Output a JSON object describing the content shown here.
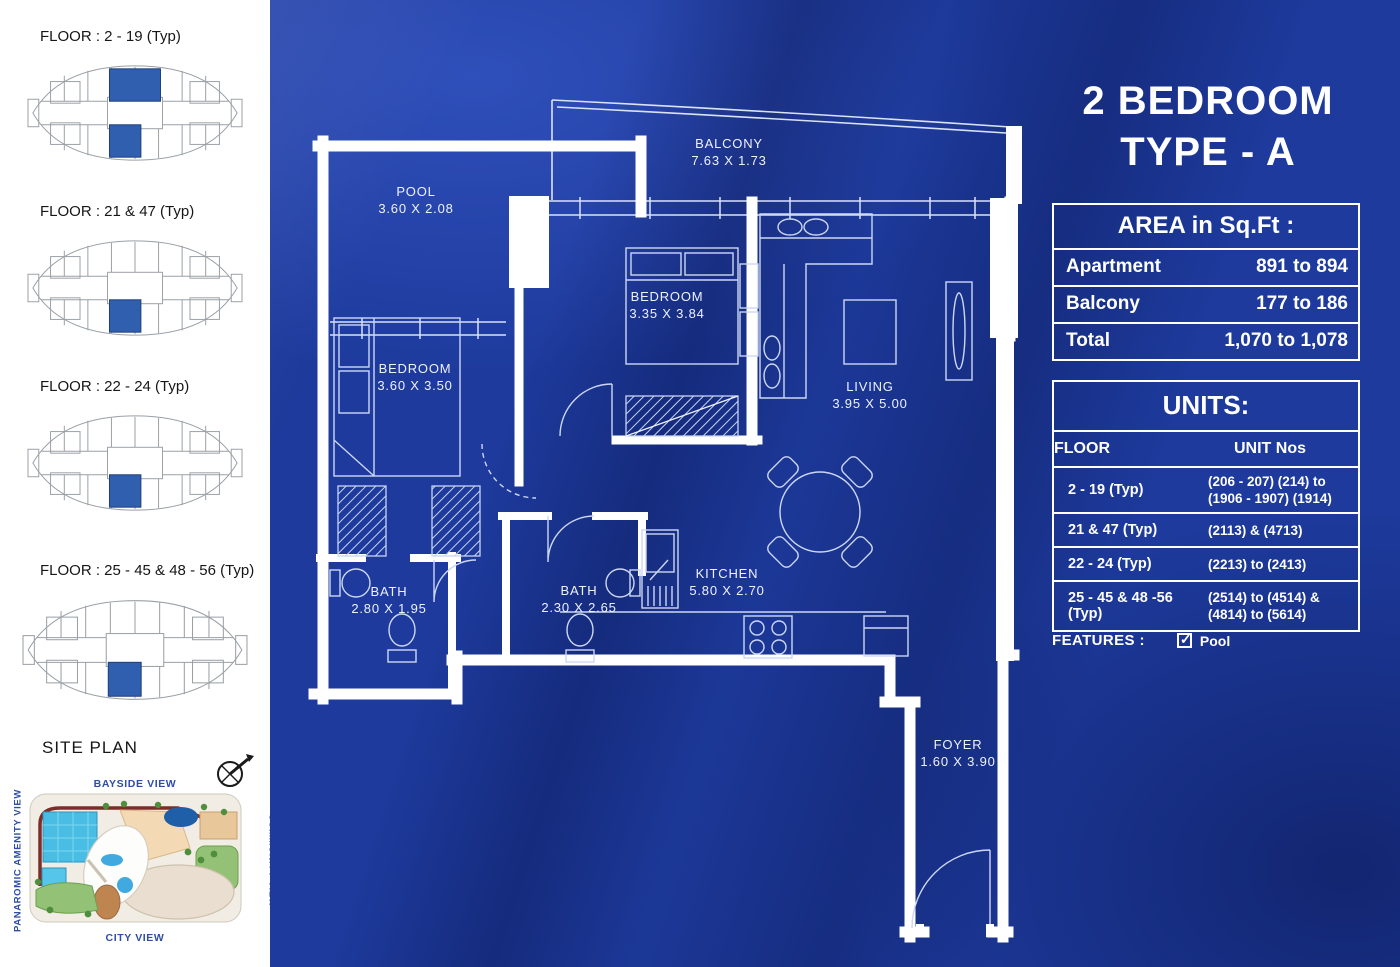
{
  "header": {
    "title_line1": "2 BEDROOM",
    "title_line2": "TYPE - A"
  },
  "area_table": {
    "title": "AREA in Sq.Ft :",
    "rows": [
      {
        "label": "Apartment",
        "value": "891 to 894"
      },
      {
        "label": "Balcony",
        "value": "177 to 186"
      },
      {
        "label": "Total",
        "value": "1,070 to 1,078"
      }
    ]
  },
  "units_table": {
    "title": "UNITS:",
    "columns": [
      "FLOOR",
      "UNIT Nos"
    ],
    "rows": [
      {
        "floor": "2 - 19 (Typ)",
        "units": "(206 - 207) (214) to (1906 - 1907) (1914)"
      },
      {
        "floor": "21 & 47 (Typ)",
        "units": "(2113) & (4713)"
      },
      {
        "floor": "22 - 24 (Typ)",
        "units": "(2213) to (2413)"
      },
      {
        "floor": "25 - 45 & 48 -56 (Typ)",
        "units": "(2514) to (4514) & (4814) to (5614)"
      }
    ]
  },
  "features": {
    "label": "FEATURES :",
    "items": [
      {
        "name": "Pool",
        "checked": true
      }
    ]
  },
  "sidebar": {
    "keyplans": [
      {
        "label": "FLOOR : 2 - 19 (Typ)",
        "highlights": [
          "top",
          "bottom"
        ]
      },
      {
        "label": "FLOOR : 21 & 47 (Typ)",
        "highlights": [
          "bottom"
        ]
      },
      {
        "label": "FLOOR : 22 - 24 (Typ)",
        "highlights": [
          "bottom"
        ]
      },
      {
        "label": "FLOOR : 25 - 45 & 48 - 56 (Typ)",
        "highlights": [
          "bottom"
        ]
      }
    ],
    "site_plan": {
      "title": "SITE PLAN",
      "views": {
        "top": "BAYSIDE VIEW",
        "bottom": "CITY VIEW",
        "left": "PANAROMIC AMENITY VIEW",
        "right": "COMMUNITY VIEW"
      }
    }
  },
  "floorplan": {
    "rooms": {
      "balcony": {
        "name": "BALCONY",
        "dims": "7.63 X 1.73"
      },
      "pool": {
        "name": "POOL",
        "dims": "3.60 X 2.08"
      },
      "bedroom1": {
        "name": "BEDROOM",
        "dims": "3.60 X 3.50"
      },
      "bedroom2": {
        "name": "BEDROOM",
        "dims": "3.35 X 3.84"
      },
      "living": {
        "name": "LIVING",
        "dims": "3.95 X 5.00"
      },
      "bath1": {
        "name": "BATH",
        "dims": "2.80 X 1.95"
      },
      "bath2": {
        "name": "BATH",
        "dims": "2.30 X 2.65"
      },
      "kitchen": {
        "name": "KITCHEN",
        "dims": "5.80 X 2.70"
      },
      "foyer": {
        "name": "FOYER",
        "dims": "1.60 X 3.90"
      }
    }
  },
  "colors": {
    "panel_blue": "#1d3a9c",
    "highlight_blue": "#2f5fae",
    "label_blue": "#2e4da6",
    "wall_white": "#ffffff"
  }
}
